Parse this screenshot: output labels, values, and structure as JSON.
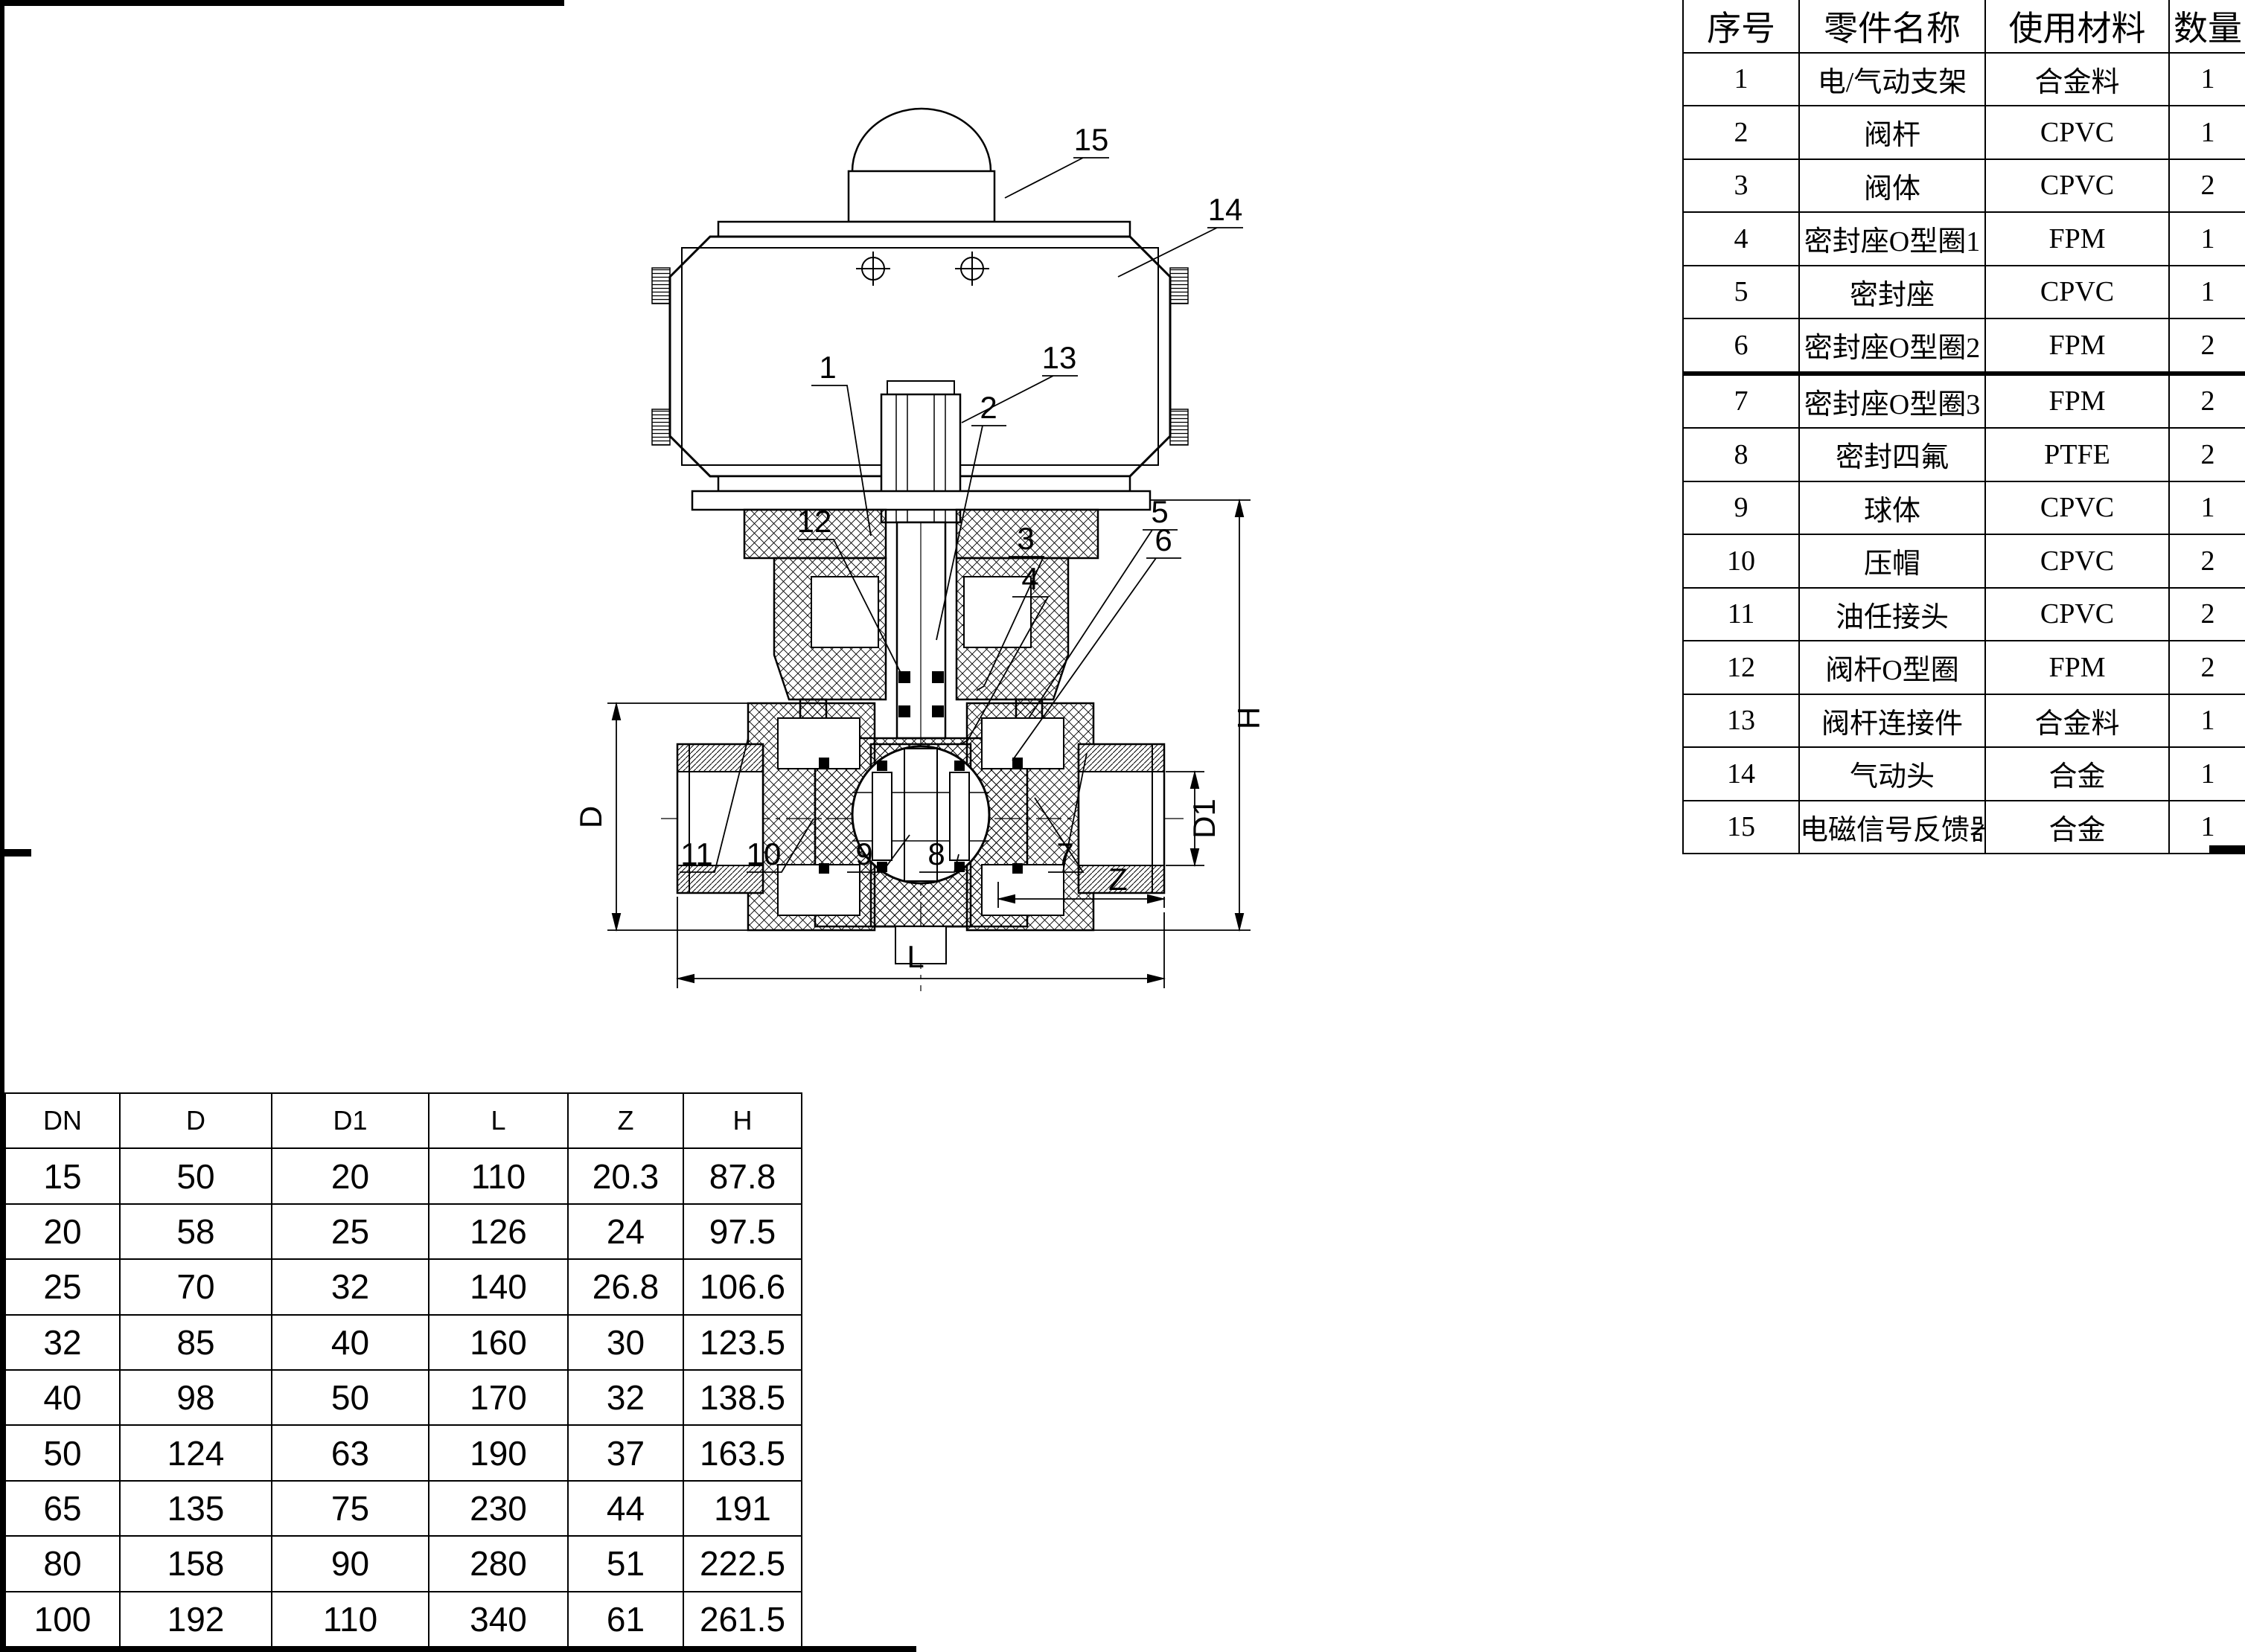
{
  "parts_table": {
    "headers": [
      "序号",
      "零件名称",
      "使用材料",
      "数量"
    ],
    "rows": [
      [
        "1",
        "电/气动支架",
        "合金料",
        "1"
      ],
      [
        "2",
        "阀杆",
        "CPVC",
        "1"
      ],
      [
        "3",
        "阀体",
        "CPVC",
        "2"
      ],
      [
        "4",
        "密封座O型圈1",
        "FPM",
        "1"
      ],
      [
        "5",
        "密封座",
        "CPVC",
        "1"
      ],
      [
        "6",
        "密封座O型圈2",
        "FPM",
        "2"
      ],
      [
        "7",
        "密封座O型圈3",
        "FPM",
        "2"
      ],
      [
        "8",
        "密封四氟",
        "PTFE",
        "2"
      ],
      [
        "9",
        "球体",
        "CPVC",
        "1"
      ],
      [
        "10",
        "压帽",
        "CPVC",
        "2"
      ],
      [
        "11",
        "油任接头",
        "CPVC",
        "2"
      ],
      [
        "12",
        "阀杆O型圈",
        "FPM",
        "2"
      ],
      [
        "13",
        "阀杆连接件",
        "合金料",
        "1"
      ],
      [
        "14",
        "气动头",
        "合金",
        "1"
      ],
      [
        "15",
        "电磁信号反馈器",
        "合金",
        "1"
      ]
    ]
  },
  "dimension_table": {
    "headers": [
      "DN",
      "D",
      "D1",
      "L",
      "Z",
      "H"
    ],
    "rows": [
      [
        "15",
        "50",
        "20",
        "110",
        "20.3",
        "87.8"
      ],
      [
        "20",
        "58",
        "25",
        "126",
        "24",
        "97.5"
      ],
      [
        "25",
        "70",
        "32",
        "140",
        "26.8",
        "106.6"
      ],
      [
        "32",
        "85",
        "40",
        "160",
        "30",
        "123.5"
      ],
      [
        "40",
        "98",
        "50",
        "170",
        "32",
        "138.5"
      ],
      [
        "50",
        "124",
        "63",
        "190",
        "37",
        "163.5"
      ],
      [
        "65",
        "135",
        "75",
        "230",
        "44",
        "191"
      ],
      [
        "80",
        "158",
        "90",
        "280",
        "51",
        "222.5"
      ],
      [
        "100",
        "192",
        "110",
        "340",
        "61",
        "261.5"
      ]
    ]
  },
  "drawing": {
    "callouts": [
      "1",
      "2",
      "3",
      "4",
      "5",
      "6",
      "7",
      "8",
      "9",
      "10",
      "11",
      "12",
      "13",
      "14",
      "15"
    ],
    "dim_labels": {
      "D": "D",
      "D1": "D1",
      "H": "H",
      "Z": "Z",
      "L": "L"
    }
  }
}
